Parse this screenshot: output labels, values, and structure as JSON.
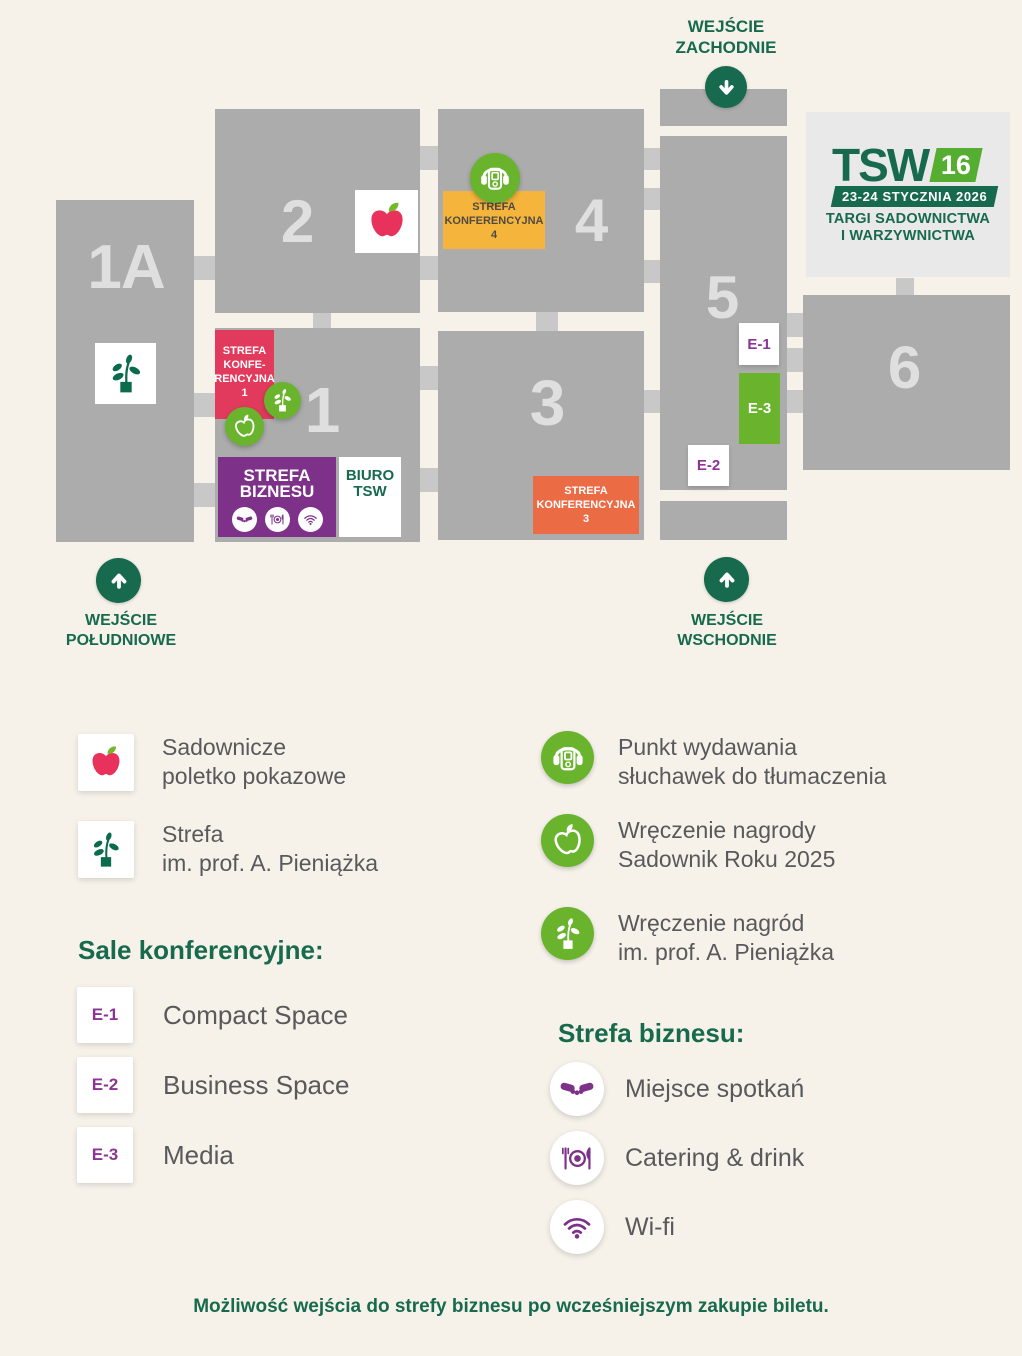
{
  "colors": {
    "accent_green_dark": "#176a4e",
    "accent_green": "#69b32d",
    "logo_green_light": "#55ad31",
    "pink": "#e23a5c",
    "purple": "#7d3189",
    "purple_text": "#8c3494",
    "yellow": "#f5b43c",
    "orange": "#eb6b45",
    "apple_red": "#e8315b",
    "leaf_green": "#76b82a",
    "plant_green": "#0c6b4b",
    "hall_gray": "#acacac",
    "connector_gray": "#c8c8c8",
    "background": "#f6f2ea",
    "logo_panel": "#e9e9e9",
    "text_gray": "#59595c"
  },
  "map": {
    "halls": [
      {
        "label": "1A"
      },
      {
        "label": "2"
      },
      {
        "label": "4"
      },
      {
        "label": "1"
      },
      {
        "label": "3"
      },
      {
        "label": "5"
      },
      {
        "label": "6"
      }
    ],
    "zones": {
      "conf4": [
        "STREFA",
        "KONFERENCYJNA",
        "4"
      ],
      "conf1": [
        "STREFA",
        "KONFE-",
        "RENCYJNA",
        "1"
      ],
      "conf3": [
        "STREFA",
        "KONFERENCYJNA",
        "3"
      ],
      "business": [
        "STREFA",
        "BIZNESU"
      ],
      "office": [
        "BIURO",
        "TSW"
      ]
    },
    "rooms": {
      "e1": "E-1",
      "e2": "E-2",
      "e3": "E-3"
    },
    "entrances": {
      "west": [
        "WEJŚCIE",
        "ZACHODNIE"
      ],
      "south": [
        "WEJŚCIE",
        "POŁUDNIOWE"
      ],
      "east": [
        "WEJŚCIE",
        "WSCHODNIE"
      ]
    },
    "logo": {
      "name": "TSW",
      "edition": "16",
      "dates": "23-24 STYCZNIA 2026",
      "tagline1": "TARGI SADOWNICTWA",
      "tagline2": "I WARZYWNICTWA"
    }
  },
  "legend": {
    "orchard": [
      "Sadownicze",
      "poletko pokazowe"
    ],
    "pieniazek_zone": [
      "Strefa",
      "im. prof. A. Pieniążka"
    ],
    "rooms_heading": "Sale konferencyjne:",
    "rooms": [
      {
        "code": "E-1",
        "name": "Compact Space"
      },
      {
        "code": "E-2",
        "name": "Business Space"
      },
      {
        "code": "E-3",
        "name": "Media"
      }
    ],
    "services": [
      {
        "icon": "headphones-icon",
        "lines": [
          "Punkt wydawania",
          "słuchawek do tłumaczenia"
        ]
      },
      {
        "icon": "award-apple-icon",
        "lines": [
          "Wręczenie nagrody",
          "Sadownik Roku 2025"
        ]
      },
      {
        "icon": "award-plant-icon",
        "lines": [
          "Wręczenie nagród",
          "im. prof. A. Pieniążka"
        ]
      }
    ],
    "business_heading": "Strefa biznesu:",
    "business": [
      {
        "icon": "handshake-icon",
        "label": "Miejsce spotkań"
      },
      {
        "icon": "catering-icon",
        "label": "Catering & drink"
      },
      {
        "icon": "wifi-icon",
        "label": "Wi-fi"
      }
    ],
    "note": "Możliwość wejścia do strefy biznesu po wcześniejszym zakupie biletu."
  }
}
